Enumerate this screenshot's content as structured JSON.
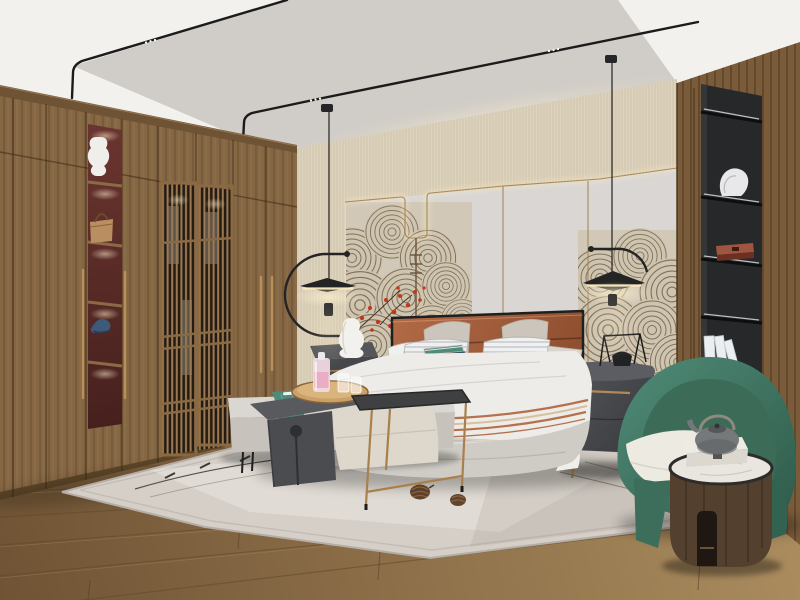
{
  "meta": {
    "title": "Modern Chinese-style bedroom interior render",
    "kind": "3D architectural visualization photograph",
    "visible_text": "none"
  },
  "palette": {
    "ceiling_outer": "#f3f1ee",
    "ceiling_recess": "#d9d5d0",
    "track_black": "#1b1b1b",
    "wall_beige": "#ddd2bc",
    "wall_panel": "#d9d6d3",
    "mural_bg": "#d0c5b1",
    "mural_line": "#6e6253",
    "led_brass": "#9c7c4f",
    "blossom_red": "#c0391d",
    "wood_wardrobe": "#856744",
    "wood_wardrobe_dark": "#6e5334",
    "wood_right": "#7a5b3a",
    "niche_red": "#5d2e2a",
    "lattice_dark": "#241c14",
    "floor_light": "#a5875c",
    "floor_dark": "#6f5334",
    "rug": "#d5cfc8",
    "bed_base": "#cfccc6",
    "duvet": "#edece9",
    "headboard": "#a9603f",
    "headboard_dark": "#7e4426",
    "pillow_beige": "#ccc5bb",
    "teal": "#4e8b7a",
    "bench": "#dad7d2",
    "table_dark": "#4b4c50",
    "stool_cream": "#ddd7cc",
    "nightstand_dark": "#4a4c50",
    "brass_hardware": "#b18a55",
    "chair_green": "#47816e",
    "chair_green_dark": "#3c6b58",
    "cushion_white": "#edeae2",
    "drum_wood": "#5a4434",
    "marble": "#e9e6e0",
    "teapot_grey": "#75797a",
    "shelf_black": "#26282a",
    "glow_warm": "#ffedc2",
    "pink_decanter": "#e9aec4"
  },
  "scene": {
    "ceiling": {
      "label": "white recessed ceiling, black magnetic track lights with LED dots, two pendant drops"
    },
    "wardrobe": {
      "label": "full-height walnut wardrobe wall",
      "items": [
        "white ceramic vase",
        "tan handbag",
        "blue cap"
      ],
      "features": [
        "lit open display niche with red back",
        "double lattice-screen doors with clothes behind",
        "long brass door handles"
      ]
    },
    "headboard_wall": {
      "label": "beige textured feature wall with LED cove",
      "features": [
        "brass trim line with U-shaped drop and rung detail",
        "grey wall panels",
        "ink fan/wave mural",
        "red blossom branches"
      ]
    },
    "pendants": {
      "label": "two black disc pendant lamps with circular arc arms, lit warm"
    },
    "bed": {
      "label": "upholstered wide bed",
      "features": [
        "terracotta leather channel-stitched headboard with black frame",
        "white duvet",
        "terracotta striped throw",
        "two beige euro pillows",
        "two white striped pillows",
        "teal lumbar pillow",
        "white bolster"
      ]
    },
    "nightstand_left": {
      "label": "dark nightstand with white gourd ceramic lamp"
    },
    "nightstand_right": {
      "label": "grey rounded nightstand, brass handle and legs, black wire decor object"
    },
    "bench_group": {
      "label": "bed-end bench set",
      "items": [
        "grey bench with black legs",
        "teal throw",
        "charcoal waterfall C-table",
        "round wooden tray",
        "pink decanter",
        "two glasses",
        "cream pouf",
        "black-top side table with brass legs"
      ]
    },
    "rug": {
      "label": "light grey area rug with thin arc motif",
      "props": [
        "two pinecones"
      ]
    },
    "shelf_right": {
      "label": "black built-in display niche in wood wall",
      "items": [
        "white abstract sculpture",
        "red lacquer box",
        "white books"
      ]
    },
    "armchair": {
      "label": "green barrel armchair with white seat cushion"
    },
    "side_table_right": {
      "label": "round wood drum table with marble top and notch",
      "items": [
        "white box",
        "grey teapot with metal handle"
      ]
    },
    "floor": {
      "label": "warm oak plank flooring"
    }
  }
}
